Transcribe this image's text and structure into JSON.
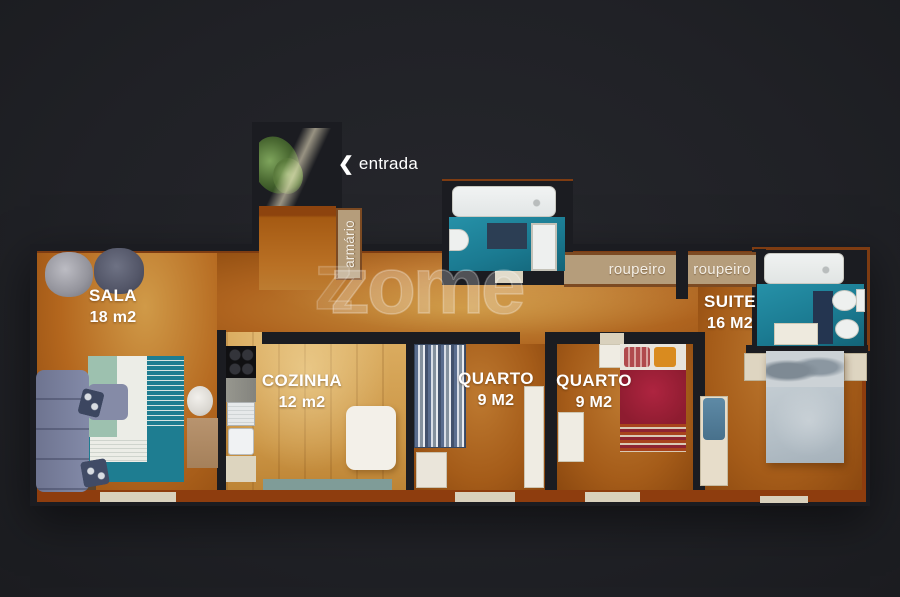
{
  "watermark": {
    "ghost": "z",
    "text": "zome"
  },
  "entrance": {
    "arrow": "❮",
    "label": "entrada"
  },
  "closets": {
    "armario": "armário",
    "roupeiro_left": "roupeiro",
    "roupeiro_right": "roupeiro"
  },
  "rooms": {
    "sala": {
      "name": "SALA",
      "area": "18 m2"
    },
    "cozinha": {
      "name": "COZINHA",
      "area": "12 m2"
    },
    "quarto_1": {
      "name": "QUARTO",
      "area": "9 M2"
    },
    "quarto_2": {
      "name": "QUARTO",
      "area": "9 M2"
    },
    "suite": {
      "name": "SUITE",
      "area": "16 M2"
    }
  },
  "colors": {
    "background": "#202126",
    "wall": "#1b1c21",
    "floor_main": "#af641f",
    "floor_kitchen": "#cb9545",
    "bathroom_teal": "#1b7b92",
    "closet_tan": "#b59d7b",
    "balcony": "#7f9c98",
    "trim_rust": "#8e3d0e",
    "label_text": "#ffffff"
  }
}
